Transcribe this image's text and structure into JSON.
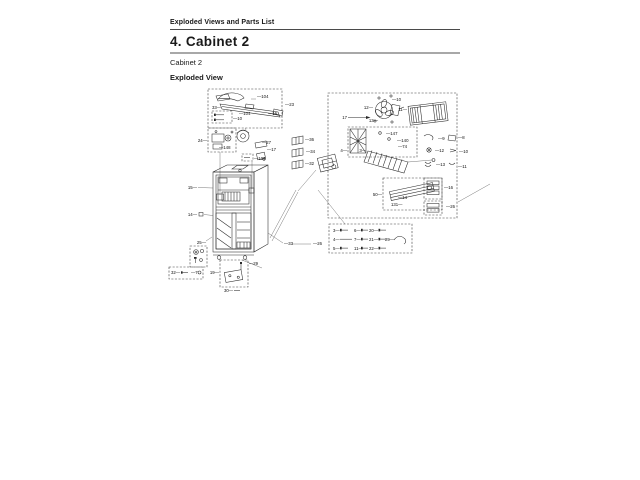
{
  "page": {
    "breadcrumb": "Exploded Views and Parts List",
    "title": "4.  Cabinet 2",
    "caption": "Cabinet 2",
    "view_label": "Exploded View"
  },
  "colors": {
    "ink": "#1a1a1a",
    "rule": "#a8a8a8"
  },
  "diagram": {
    "callouts": [
      {
        "x": 212,
        "y": 109,
        "t": "33—",
        "a": "start"
      },
      {
        "x": 257,
        "y": 98,
        "t": "—104",
        "a": "start"
      },
      {
        "x": 285,
        "y": 106,
        "t": "—23",
        "a": "start"
      },
      {
        "x": 239,
        "y": 115,
        "t": "—104",
        "a": "start"
      },
      {
        "x": 268,
        "y": 115,
        "t": "—16",
        "a": "start"
      },
      {
        "x": 233,
        "y": 120,
        "t": "—10",
        "a": "start"
      },
      {
        "x": 207,
        "y": 142,
        "t": "24—",
        "a": "end"
      },
      {
        "x": 219,
        "y": 149,
        "t": "—148",
        "a": "start"
      },
      {
        "x": 262,
        "y": 144,
        "t": "—27",
        "a": "start"
      },
      {
        "x": 267,
        "y": 151,
        "t": "—17",
        "a": "start"
      },
      {
        "x": 254,
        "y": 160,
        "t": "—104",
        "a": "start"
      },
      {
        "x": 197,
        "y": 189,
        "t": "15—",
        "a": "end"
      },
      {
        "x": 197,
        "y": 216,
        "t": "14—",
        "a": "end"
      },
      {
        "x": 206,
        "y": 244,
        "t": "25—",
        "a": "end"
      },
      {
        "x": 284,
        "y": 245,
        "t": "—33",
        "a": "start"
      },
      {
        "x": 313,
        "y": 245,
        "t": "—26",
        "a": "start"
      },
      {
        "x": 305,
        "y": 141,
        "t": "—36",
        "a": "start"
      },
      {
        "x": 306,
        "y": 153,
        "t": "—34",
        "a": "start"
      },
      {
        "x": 305,
        "y": 165,
        "t": "—32",
        "a": "start"
      },
      {
        "x": 347,
        "y": 119,
        "t": "17",
        "a": "end"
      },
      {
        "x": 373,
        "y": 109,
        "t": "12—",
        "a": "end"
      },
      {
        "x": 392,
        "y": 101,
        "t": "—10",
        "a": "start"
      },
      {
        "x": 378,
        "y": 122,
        "t": "13—",
        "a": "end"
      },
      {
        "x": 407,
        "y": 111,
        "t": "11—",
        "a": "end"
      },
      {
        "x": 386,
        "y": 135,
        "t": "—147",
        "a": "start"
      },
      {
        "x": 397,
        "y": 142,
        "t": "—140",
        "a": "start"
      },
      {
        "x": 398,
        "y": 148,
        "t": "—74",
        "a": "start"
      },
      {
        "x": 347,
        "y": 152,
        "t": "4—",
        "a": "end"
      },
      {
        "x": 366,
        "y": 152,
        "t": "3—",
        "a": "end"
      },
      {
        "x": 382,
        "y": 196,
        "t": "50—",
        "a": "end"
      },
      {
        "x": 398,
        "y": 199,
        "t": "—14",
        "a": "start"
      },
      {
        "x": 391,
        "y": 206,
        "t": "131—",
        "a": "start"
      },
      {
        "x": 438,
        "y": 140,
        "t": "—9",
        "a": "start"
      },
      {
        "x": 435,
        "y": 152,
        "t": "—12",
        "a": "start"
      },
      {
        "x": 436,
        "y": 166,
        "t": "—13",
        "a": "start"
      },
      {
        "x": 444,
        "y": 189,
        "t": "—16",
        "a": "start"
      },
      {
        "x": 446,
        "y": 208,
        "t": "—26",
        "a": "start"
      },
      {
        "x": 458,
        "y": 139,
        "t": "—8",
        "a": "start"
      },
      {
        "x": 459,
        "y": 153,
        "t": "—10",
        "a": "start"
      },
      {
        "x": 458,
        "y": 168,
        "t": "—11",
        "a": "start"
      },
      {
        "x": 333,
        "y": 232,
        "t": "3—",
        "a": "start"
      },
      {
        "x": 354,
        "y": 232,
        "t": "6—",
        "a": "start"
      },
      {
        "x": 369,
        "y": 232,
        "t": "20—",
        "a": "start"
      },
      {
        "x": 333,
        "y": 241,
        "t": "4—",
        "a": "start"
      },
      {
        "x": 354,
        "y": 241,
        "t": "7—",
        "a": "start"
      },
      {
        "x": 369,
        "y": 241,
        "t": "21—",
        "a": "start"
      },
      {
        "x": 385,
        "y": 241,
        "t": "29—",
        "a": "start"
      },
      {
        "x": 333,
        "y": 250,
        "t": "5—",
        "a": "start"
      },
      {
        "x": 354,
        "y": 250,
        "t": "11—",
        "a": "start"
      },
      {
        "x": 369,
        "y": 250,
        "t": "22—",
        "a": "start"
      },
      {
        "x": 171,
        "y": 274,
        "t": "32—",
        "a": "start"
      },
      {
        "x": 191,
        "y": 274,
        "t": "—7",
        "a": "start"
      },
      {
        "x": 219,
        "y": 274,
        "t": "19—",
        "a": "end"
      },
      {
        "x": 249,
        "y": 265,
        "t": "—29",
        "a": "start"
      },
      {
        "x": 224,
        "y": 292,
        "t": "30—",
        "a": "start"
      }
    ]
  }
}
